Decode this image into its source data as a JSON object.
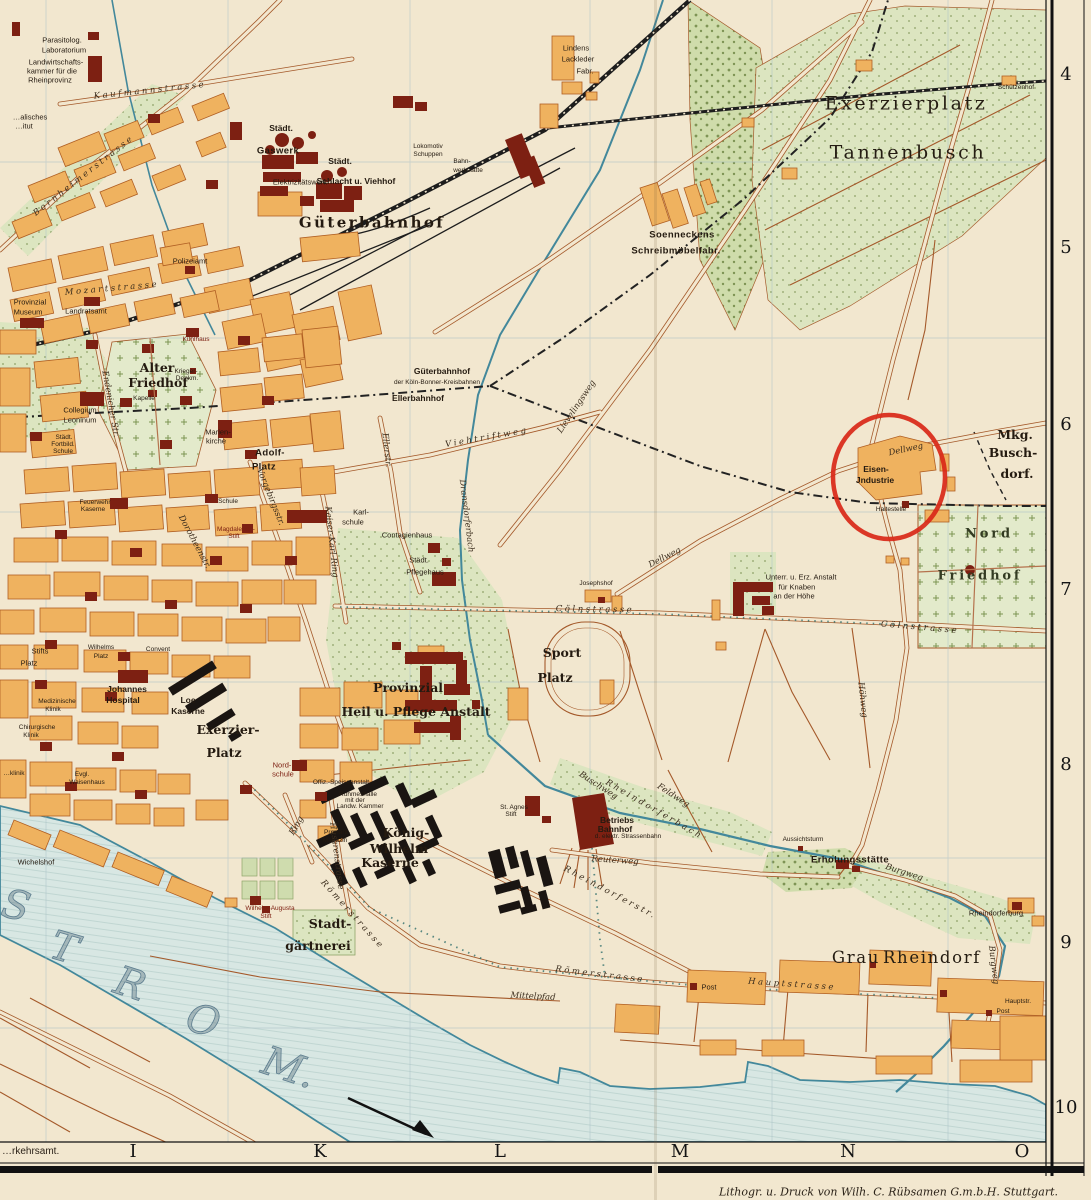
{
  "colors": {
    "paper": "#f2e7cf",
    "block": "#efb25f",
    "block_stroke": "#b05f23",
    "landmark": "#7d2012",
    "kaserne": "#1a1512",
    "water": "#d8e7e3",
    "water_edge": "#43889b",
    "green": "#dce5c0",
    "road": "#a4592a",
    "rail": "#1d1d1d",
    "grid": "#a9bfc7",
    "circle": "#d92818",
    "ink": "#241a10"
  },
  "frame": {
    "grid_numbers": [
      {
        "t": "4",
        "y": 75
      },
      {
        "t": "5",
        "y": 248
      },
      {
        "t": "6",
        "y": 425
      },
      {
        "t": "7",
        "y": 590
      },
      {
        "t": "8",
        "y": 765
      },
      {
        "t": "9",
        "y": 943
      },
      {
        "t": "10",
        "y": 1108
      }
    ],
    "letters": [
      {
        "t": "I",
        "x": 133
      },
      {
        "t": "K",
        "x": 320
      },
      {
        "t": "L",
        "x": 500
      },
      {
        "t": "M",
        "x": 680
      },
      {
        "t": "N",
        "x": 848
      },
      {
        "t": "O",
        "x": 1022
      }
    ],
    "credit": "Lithogr. u. Druck von Wilh. C. Rübsamen G.m.b.H. Stuttgart.",
    "corner": "…rkehrsamt."
  },
  "map": {
    "annotation": {
      "shape": "ellipse",
      "cx": 889,
      "cy": 477,
      "rx": 56,
      "ry": 62,
      "stroke_width": 4.5
    },
    "labels": [
      {
        "t": "Parasitolog.",
        "x": 62,
        "y": 40,
        "c": "t7"
      },
      {
        "t": "Laboratorium",
        "x": 64,
        "y": 50,
        "c": "t7"
      },
      {
        "t": "Landwirtschafts-",
        "x": 56,
        "y": 62,
        "c": "t7"
      },
      {
        "t": "kammer für die",
        "x": 52,
        "y": 71,
        "c": "t7"
      },
      {
        "t": "Rheinprovinz",
        "x": 50,
        "y": 80,
        "c": "t7"
      },
      {
        "t": "…alisches",
        "x": 30,
        "y": 117,
        "c": "t7"
      },
      {
        "t": "…itut",
        "x": 24,
        "y": 126,
        "c": "t7"
      },
      {
        "t": "Kaufmannstrasse",
        "x": 150,
        "y": 91,
        "c": "sp",
        "r": -6
      },
      {
        "t": "Bornheimerstrasse",
        "x": 84,
        "y": 176,
        "c": "sp",
        "r": -38
      },
      {
        "t": "Städt.",
        "x": 281,
        "y": 128,
        "c": "t8"
      },
      {
        "t": "Gaswerk",
        "x": 278,
        "y": 151,
        "c": "b9"
      },
      {
        "t": "Elektrizitätswerk",
        "x": 300,
        "y": 182,
        "c": "t7"
      },
      {
        "t": "Städt.",
        "x": 340,
        "y": 161,
        "c": "t8"
      },
      {
        "t": "Schlacht u. Viehhof",
        "x": 356,
        "y": 181,
        "c": "t8"
      },
      {
        "t": "Lokomotiv",
        "x": 428,
        "y": 147,
        "c": "t6"
      },
      {
        "t": "Schuppen",
        "x": 428,
        "y": 155,
        "c": "t6"
      },
      {
        "t": "Bahn-",
        "x": 462,
        "y": 162,
        "c": "t6"
      },
      {
        "t": "werkstätte",
        "x": 468,
        "y": 171,
        "c": "t6"
      },
      {
        "t": "Güterbahnhof",
        "x": 372,
        "y": 223,
        "c": "g16"
      },
      {
        "t": "Polizeiamt",
        "x": 190,
        "y": 261,
        "c": "t7"
      },
      {
        "t": "Provinzial",
        "x": 30,
        "y": 302,
        "c": "t7"
      },
      {
        "t": "Museum",
        "x": 28,
        "y": 312,
        "c": "t7"
      },
      {
        "t": "Landratsamt",
        "x": 86,
        "y": 311,
        "c": "t7"
      },
      {
        "t": "Mozartstrasse",
        "x": 112,
        "y": 289,
        "c": "sp",
        "r": -5
      },
      {
        "t": "Kühlhaus",
        "x": 196,
        "y": 340,
        "c": "t6",
        "col": "r"
      },
      {
        "t": "Lindens",
        "x": 576,
        "y": 48,
        "c": "t7"
      },
      {
        "t": "Lackleder",
        "x": 578,
        "y": 59,
        "c": "t7"
      },
      {
        "t": "Fabr.",
        "x": 585,
        "y": 71,
        "c": "t7"
      },
      {
        "t": "Soenneckens",
        "x": 682,
        "y": 235,
        "c": "b9"
      },
      {
        "t": "Schreibmöbelfabr.",
        "x": 676,
        "y": 251,
        "c": "b9"
      },
      {
        "t": "Exerzierplatz",
        "x": 906,
        "y": 104,
        "c": "h19"
      },
      {
        "t": "Tannenbusch",
        "x": 908,
        "y": 153,
        "c": "h19"
      },
      {
        "t": "Schützenhof",
        "x": 1016,
        "y": 88,
        "c": "t6"
      },
      {
        "t": "Alter",
        "x": 157,
        "y": 368,
        "c": "m12"
      },
      {
        "t": "Friedhof",
        "x": 158,
        "y": 383,
        "c": "m12"
      },
      {
        "t": "Kapelle",
        "x": 144,
        "y": 399,
        "c": "t6"
      },
      {
        "t": "Krieger-",
        "x": 186,
        "y": 372,
        "c": "t6"
      },
      {
        "t": "Denkm.",
        "x": 187,
        "y": 379,
        "c": "t6"
      },
      {
        "t": "Collegium",
        "x": 80,
        "y": 410,
        "c": "t7"
      },
      {
        "t": "Leoninum",
        "x": 80,
        "y": 420,
        "c": "t7"
      },
      {
        "t": "Städt.",
        "x": 64,
        "y": 438,
        "c": "t6"
      },
      {
        "t": "Fortbild.",
        "x": 63,
        "y": 445,
        "c": "t6"
      },
      {
        "t": "Schule",
        "x": 63,
        "y": 452,
        "c": "t6"
      },
      {
        "t": "Marien-",
        "x": 218,
        "y": 432,
        "c": "t7"
      },
      {
        "t": "kirche",
        "x": 216,
        "y": 441,
        "c": "t7"
      },
      {
        "t": "Adolf-",
        "x": 270,
        "y": 453,
        "c": "b9"
      },
      {
        "t": "Platz",
        "x": 264,
        "y": 467,
        "c": "b9"
      },
      {
        "t": "Feuerwehr",
        "x": 95,
        "y": 503,
        "c": "t6"
      },
      {
        "t": "Kaserne",
        "x": 93,
        "y": 510,
        "c": "t6"
      },
      {
        "t": "Endenicher Str.",
        "x": 110,
        "y": 404,
        "c": "st",
        "r": 80
      },
      {
        "t": "Güterbahnhof",
        "x": 442,
        "y": 371,
        "c": "t8"
      },
      {
        "t": "der Köln-Bonner-Kreisbahnen",
        "x": 437,
        "y": 383,
        "c": "t6"
      },
      {
        "t": "Ellerbahnhof",
        "x": 418,
        "y": 398,
        "c": "t8"
      },
      {
        "t": "Viehtriftweg",
        "x": 487,
        "y": 438,
        "c": "sp",
        "r": -10
      },
      {
        "t": "Lievelingsweg",
        "x": 577,
        "y": 407,
        "c": "st",
        "r": -56
      },
      {
        "t": "Ellerstr.",
        "x": 386,
        "y": 450,
        "c": "st",
        "r": 84
      },
      {
        "t": "Vorgebirgsstr.",
        "x": 270,
        "y": 497,
        "c": "st",
        "r": 68
      },
      {
        "t": "Kaiser-Karl-Ring",
        "x": 331,
        "y": 542,
        "c": "st",
        "r": 84
      },
      {
        "t": "Dorotheenstr.",
        "x": 194,
        "y": 542,
        "c": "st",
        "r": 62
      },
      {
        "t": "Magdalenen-",
        "x": 236,
        "y": 530,
        "c": "t6",
        "col": "r"
      },
      {
        "t": "Stift",
        "x": 234,
        "y": 537,
        "c": "t6",
        "col": "r"
      },
      {
        "t": "Schule",
        "x": 228,
        "y": 502,
        "c": "t6"
      },
      {
        "t": "Karl-",
        "x": 361,
        "y": 512,
        "c": "t7"
      },
      {
        "t": "schule",
        "x": 353,
        "y": 522,
        "c": "t7"
      },
      {
        "t": "Contagienhaus",
        "x": 407,
        "y": 535,
        "c": "t7"
      },
      {
        "t": "Städt.",
        "x": 419,
        "y": 560,
        "c": "t7"
      },
      {
        "t": "Pflegehaus",
        "x": 425,
        "y": 572,
        "c": "t7"
      },
      {
        "t": "Dransdorferbach",
        "x": 466,
        "y": 516,
        "c": "st",
        "r": 83
      },
      {
        "t": "Eisen-",
        "x": 876,
        "y": 469,
        "c": "t8"
      },
      {
        "t": "Jndustrie",
        "x": 875,
        "y": 480,
        "c": "t8"
      },
      {
        "t": "Dellweg",
        "x": 906,
        "y": 450,
        "c": "st",
        "r": -12
      },
      {
        "t": "Dellweg",
        "x": 665,
        "y": 558,
        "c": "st",
        "r": -27
      },
      {
        "t": "Haltestelle",
        "x": 891,
        "y": 510,
        "c": "t6"
      },
      {
        "t": "Mkg.",
        "x": 1015,
        "y": 435,
        "c": "m12"
      },
      {
        "t": "Busch-",
        "x": 1013,
        "y": 453,
        "c": "m12"
      },
      {
        "t": "dorf.",
        "x": 1017,
        "y": 474,
        "c": "m12"
      },
      {
        "t": "Nord",
        "x": 989,
        "y": 534,
        "c": "cem"
      },
      {
        "t": "Friedhof",
        "x": 980,
        "y": 576,
        "c": "cem"
      },
      {
        "t": "Höhweg",
        "x": 862,
        "y": 700,
        "c": "st",
        "r": 84
      },
      {
        "t": "Unterr. u. Erz. Anstalt",
        "x": 801,
        "y": 577,
        "c": "t7"
      },
      {
        "t": "für Knaben",
        "x": 797,
        "y": 587,
        "c": "t7"
      },
      {
        "t": "an der Höhe",
        "x": 794,
        "y": 596,
        "c": "t7"
      },
      {
        "t": "Josephshof",
        "x": 596,
        "y": 584,
        "c": "t6"
      },
      {
        "t": "Cölnstrasse",
        "x": 595,
        "y": 610,
        "c": "sp",
        "r": 1
      },
      {
        "t": "Cölnstrasse",
        "x": 920,
        "y": 628,
        "c": "sp",
        "r": 5
      },
      {
        "t": "Sport",
        "x": 562,
        "y": 653,
        "c": "m12"
      },
      {
        "t": "Platz",
        "x": 555,
        "y": 678,
        "c": "m12"
      },
      {
        "t": "Provinzial",
        "x": 408,
        "y": 688,
        "c": "m12"
      },
      {
        "t": "Heil u. Pflege Anstalt",
        "x": 416,
        "y": 712,
        "c": "m12"
      },
      {
        "t": "Stifts",
        "x": 40,
        "y": 651,
        "c": "t7"
      },
      {
        "t": "Platz",
        "x": 29,
        "y": 663,
        "c": "t7"
      },
      {
        "t": "Wilhelms",
        "x": 101,
        "y": 648,
        "c": "t6"
      },
      {
        "t": "Platz",
        "x": 101,
        "y": 657,
        "c": "t6"
      },
      {
        "t": "Convent",
        "x": 158,
        "y": 650,
        "c": "t6"
      },
      {
        "t": "Johannes",
        "x": 127,
        "y": 689,
        "c": "t8"
      },
      {
        "t": "Hospital",
        "x": 123,
        "y": 700,
        "c": "t8"
      },
      {
        "t": "Medizinische",
        "x": 57,
        "y": 702,
        "c": "t6"
      },
      {
        "t": "Klinik",
        "x": 53,
        "y": 710,
        "c": "t6"
      },
      {
        "t": "Chirurgische",
        "x": 37,
        "y": 728,
        "c": "t6"
      },
      {
        "t": "Klinik",
        "x": 31,
        "y": 736,
        "c": "t6"
      },
      {
        "t": "…klinik",
        "x": 14,
        "y": 774,
        "c": "t6"
      },
      {
        "t": "Evgl.",
        "x": 82,
        "y": 775,
        "c": "t6"
      },
      {
        "t": "Waisenhaus",
        "x": 87,
        "y": 783,
        "c": "t6"
      },
      {
        "t": "Loe",
        "x": 188,
        "y": 700,
        "c": "t8"
      },
      {
        "t": "Kaserne",
        "x": 188,
        "y": 711,
        "c": "t8"
      },
      {
        "t": "Exerzier-",
        "x": 228,
        "y": 730,
        "c": "m12"
      },
      {
        "t": "Platz",
        "x": 224,
        "y": 753,
        "c": "m12"
      },
      {
        "t": "Nord-",
        "x": 282,
        "y": 765,
        "c": "t7",
        "col": "r"
      },
      {
        "t": "schule",
        "x": 283,
        "y": 774,
        "c": "t7",
        "col": "r"
      },
      {
        "t": "Offiz.-Speiseanstalt",
        "x": 341,
        "y": 783,
        "c": "t6"
      },
      {
        "t": "Ruhmeshalle",
        "x": 358,
        "y": 795,
        "c": "t6"
      },
      {
        "t": "mit der",
        "x": 355,
        "y": 801,
        "c": "t6"
      },
      {
        "t": "Landw. Kammer",
        "x": 360,
        "y": 807,
        "c": "t6"
      },
      {
        "t": "König-",
        "x": 406,
        "y": 833,
        "c": "m12"
      },
      {
        "t": "Wilhelm",
        "x": 399,
        "y": 849,
        "c": "m12"
      },
      {
        "t": "Kaserne",
        "x": 390,
        "y": 863,
        "c": "m12"
      },
      {
        "t": "Proviant-",
        "x": 337,
        "y": 833,
        "c": "t6"
      },
      {
        "t": "Magazin",
        "x": 335,
        "y": 841,
        "c": "t6"
      },
      {
        "t": "Ring",
        "x": 297,
        "y": 826,
        "c": "st",
        "r": -60
      },
      {
        "t": "Husarenstrasse",
        "x": 336,
        "y": 856,
        "c": "st",
        "r": 83
      },
      {
        "t": "Römerstrasse",
        "x": 352,
        "y": 915,
        "c": "sp",
        "r": 48
      },
      {
        "t": "Römerstrasse",
        "x": 600,
        "y": 975,
        "c": "sp",
        "r": 7
      },
      {
        "t": "Hauptstrasse",
        "x": 792,
        "y": 985,
        "c": "sp",
        "r": 4
      },
      {
        "t": "Wilhelm-Augusta",
        "x": 270,
        "y": 909,
        "c": "t6",
        "col": "r"
      },
      {
        "t": "Stift",
        "x": 266,
        "y": 917,
        "c": "t6",
        "col": "r"
      },
      {
        "t": "Wichelshof",
        "x": 36,
        "y": 862,
        "c": "t7"
      },
      {
        "t": "Stadt-",
        "x": 330,
        "y": 924,
        "c": "m12"
      },
      {
        "t": "gärtnerei",
        "x": 318,
        "y": 946,
        "c": "m12"
      },
      {
        "t": "St. Agnes",
        "x": 514,
        "y": 808,
        "c": "t6"
      },
      {
        "t": "Stift",
        "x": 511,
        "y": 815,
        "c": "t6"
      },
      {
        "t": "Betriebs",
        "x": 617,
        "y": 820,
        "c": "t8"
      },
      {
        "t": "Bahnhof",
        "x": 615,
        "y": 829,
        "c": "t8"
      },
      {
        "t": "d. elektr. Strassenbahn",
        "x": 628,
        "y": 837,
        "c": "t6"
      },
      {
        "t": "Reuterweg",
        "x": 615,
        "y": 861,
        "c": "st",
        "r": 4
      },
      {
        "t": "Rheindorferbach",
        "x": 654,
        "y": 810,
        "c": "sp",
        "r": 30
      },
      {
        "t": "Feldweg",
        "x": 673,
        "y": 796,
        "c": "st",
        "r": 33
      },
      {
        "t": "Buschweg",
        "x": 598,
        "y": 786,
        "c": "st",
        "r": 33
      },
      {
        "t": "Rheindorferstr.",
        "x": 610,
        "y": 893,
        "c": "sp",
        "r": 28
      },
      {
        "t": "Mittelpfad",
        "x": 533,
        "y": 997,
        "c": "st",
        "r": 3
      },
      {
        "t": "Erholungsstätte",
        "x": 850,
        "y": 860,
        "c": "b9"
      },
      {
        "t": "Aussichtsturm",
        "x": 803,
        "y": 840,
        "c": "t6"
      },
      {
        "t": "Burgweg",
        "x": 904,
        "y": 873,
        "c": "st",
        "r": 18
      },
      {
        "t": "Burgweg",
        "x": 993,
        "y": 965,
        "c": "st",
        "r": 83
      },
      {
        "t": "Rheindorferburg",
        "x": 996,
        "y": 913,
        "c": "t7"
      },
      {
        "t": "Grau",
        "x": 856,
        "y": 958,
        "c": "h16"
      },
      {
        "t": "Rheindorf",
        "x": 932,
        "y": 958,
        "c": "h16"
      },
      {
        "t": "Post",
        "x": 709,
        "y": 987,
        "c": "t7"
      },
      {
        "t": "Hauptstr.",
        "x": 1018,
        "y": 1002,
        "c": "t6"
      },
      {
        "t": "Post",
        "x": 1003,
        "y": 1012,
        "c": "t6"
      },
      {
        "t": "S",
        "x": 16,
        "y": 906,
        "c": "riv",
        "r": 14
      },
      {
        "t": "T",
        "x": 64,
        "y": 948,
        "c": "riv",
        "r": 16
      },
      {
        "t": "R",
        "x": 130,
        "y": 984,
        "c": "riv",
        "r": 18
      },
      {
        "t": "O",
        "x": 203,
        "y": 1021,
        "c": "riv",
        "r": 18
      },
      {
        "t": "M.",
        "x": 289,
        "y": 1068,
        "c": "riv",
        "r": 18
      }
    ]
  }
}
